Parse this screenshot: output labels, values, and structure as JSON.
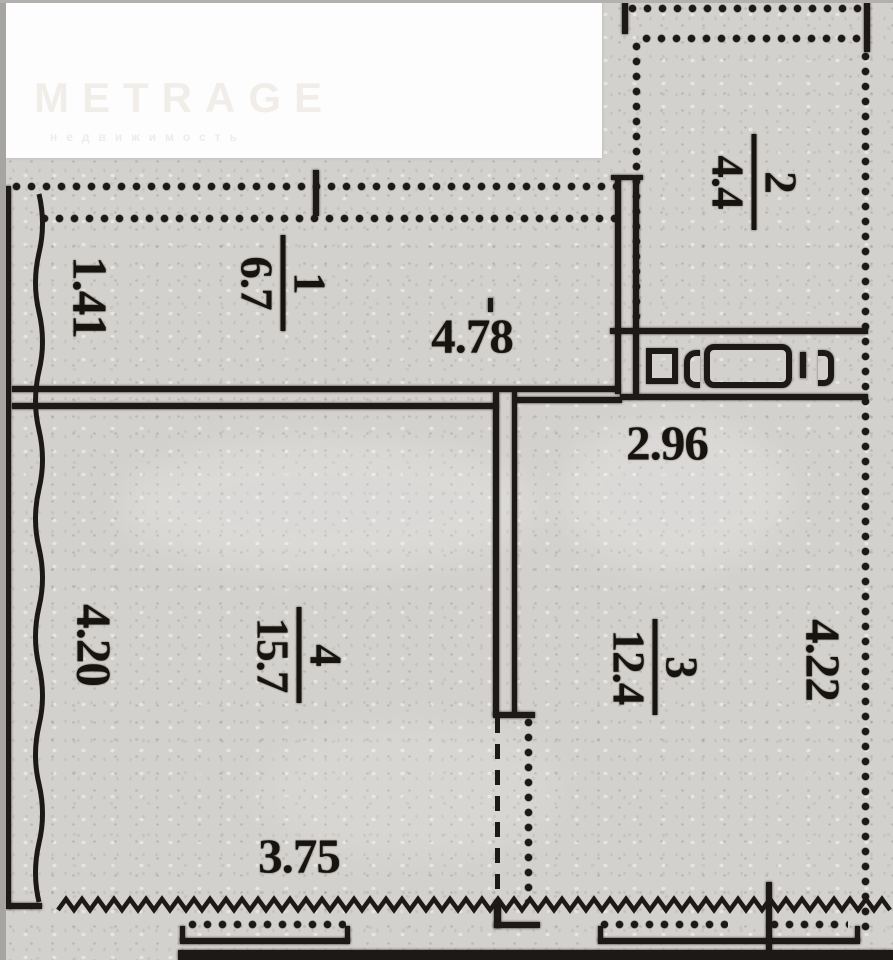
{
  "logo": {
    "brand": "METRAGE",
    "tagline": "недвижимость"
  },
  "plan_type": "apartment floor plan",
  "rooms": [
    {
      "number": "1",
      "area": "6.7"
    },
    {
      "number": "2",
      "area": "4.4"
    },
    {
      "number": "3",
      "area": "12.4"
    },
    {
      "number": "4",
      "area": "15.7"
    }
  ],
  "dimensions": {
    "room1_depth": "1.41",
    "room1_width": "4.78",
    "hall_width": "2.96",
    "room4_depth": "4.20",
    "room3_depth": "4.22",
    "room4_width": "3.75"
  },
  "colors": {
    "paper": "#d3d1ce",
    "ink": "#1c1916",
    "logo_text": "#f1eeea"
  }
}
